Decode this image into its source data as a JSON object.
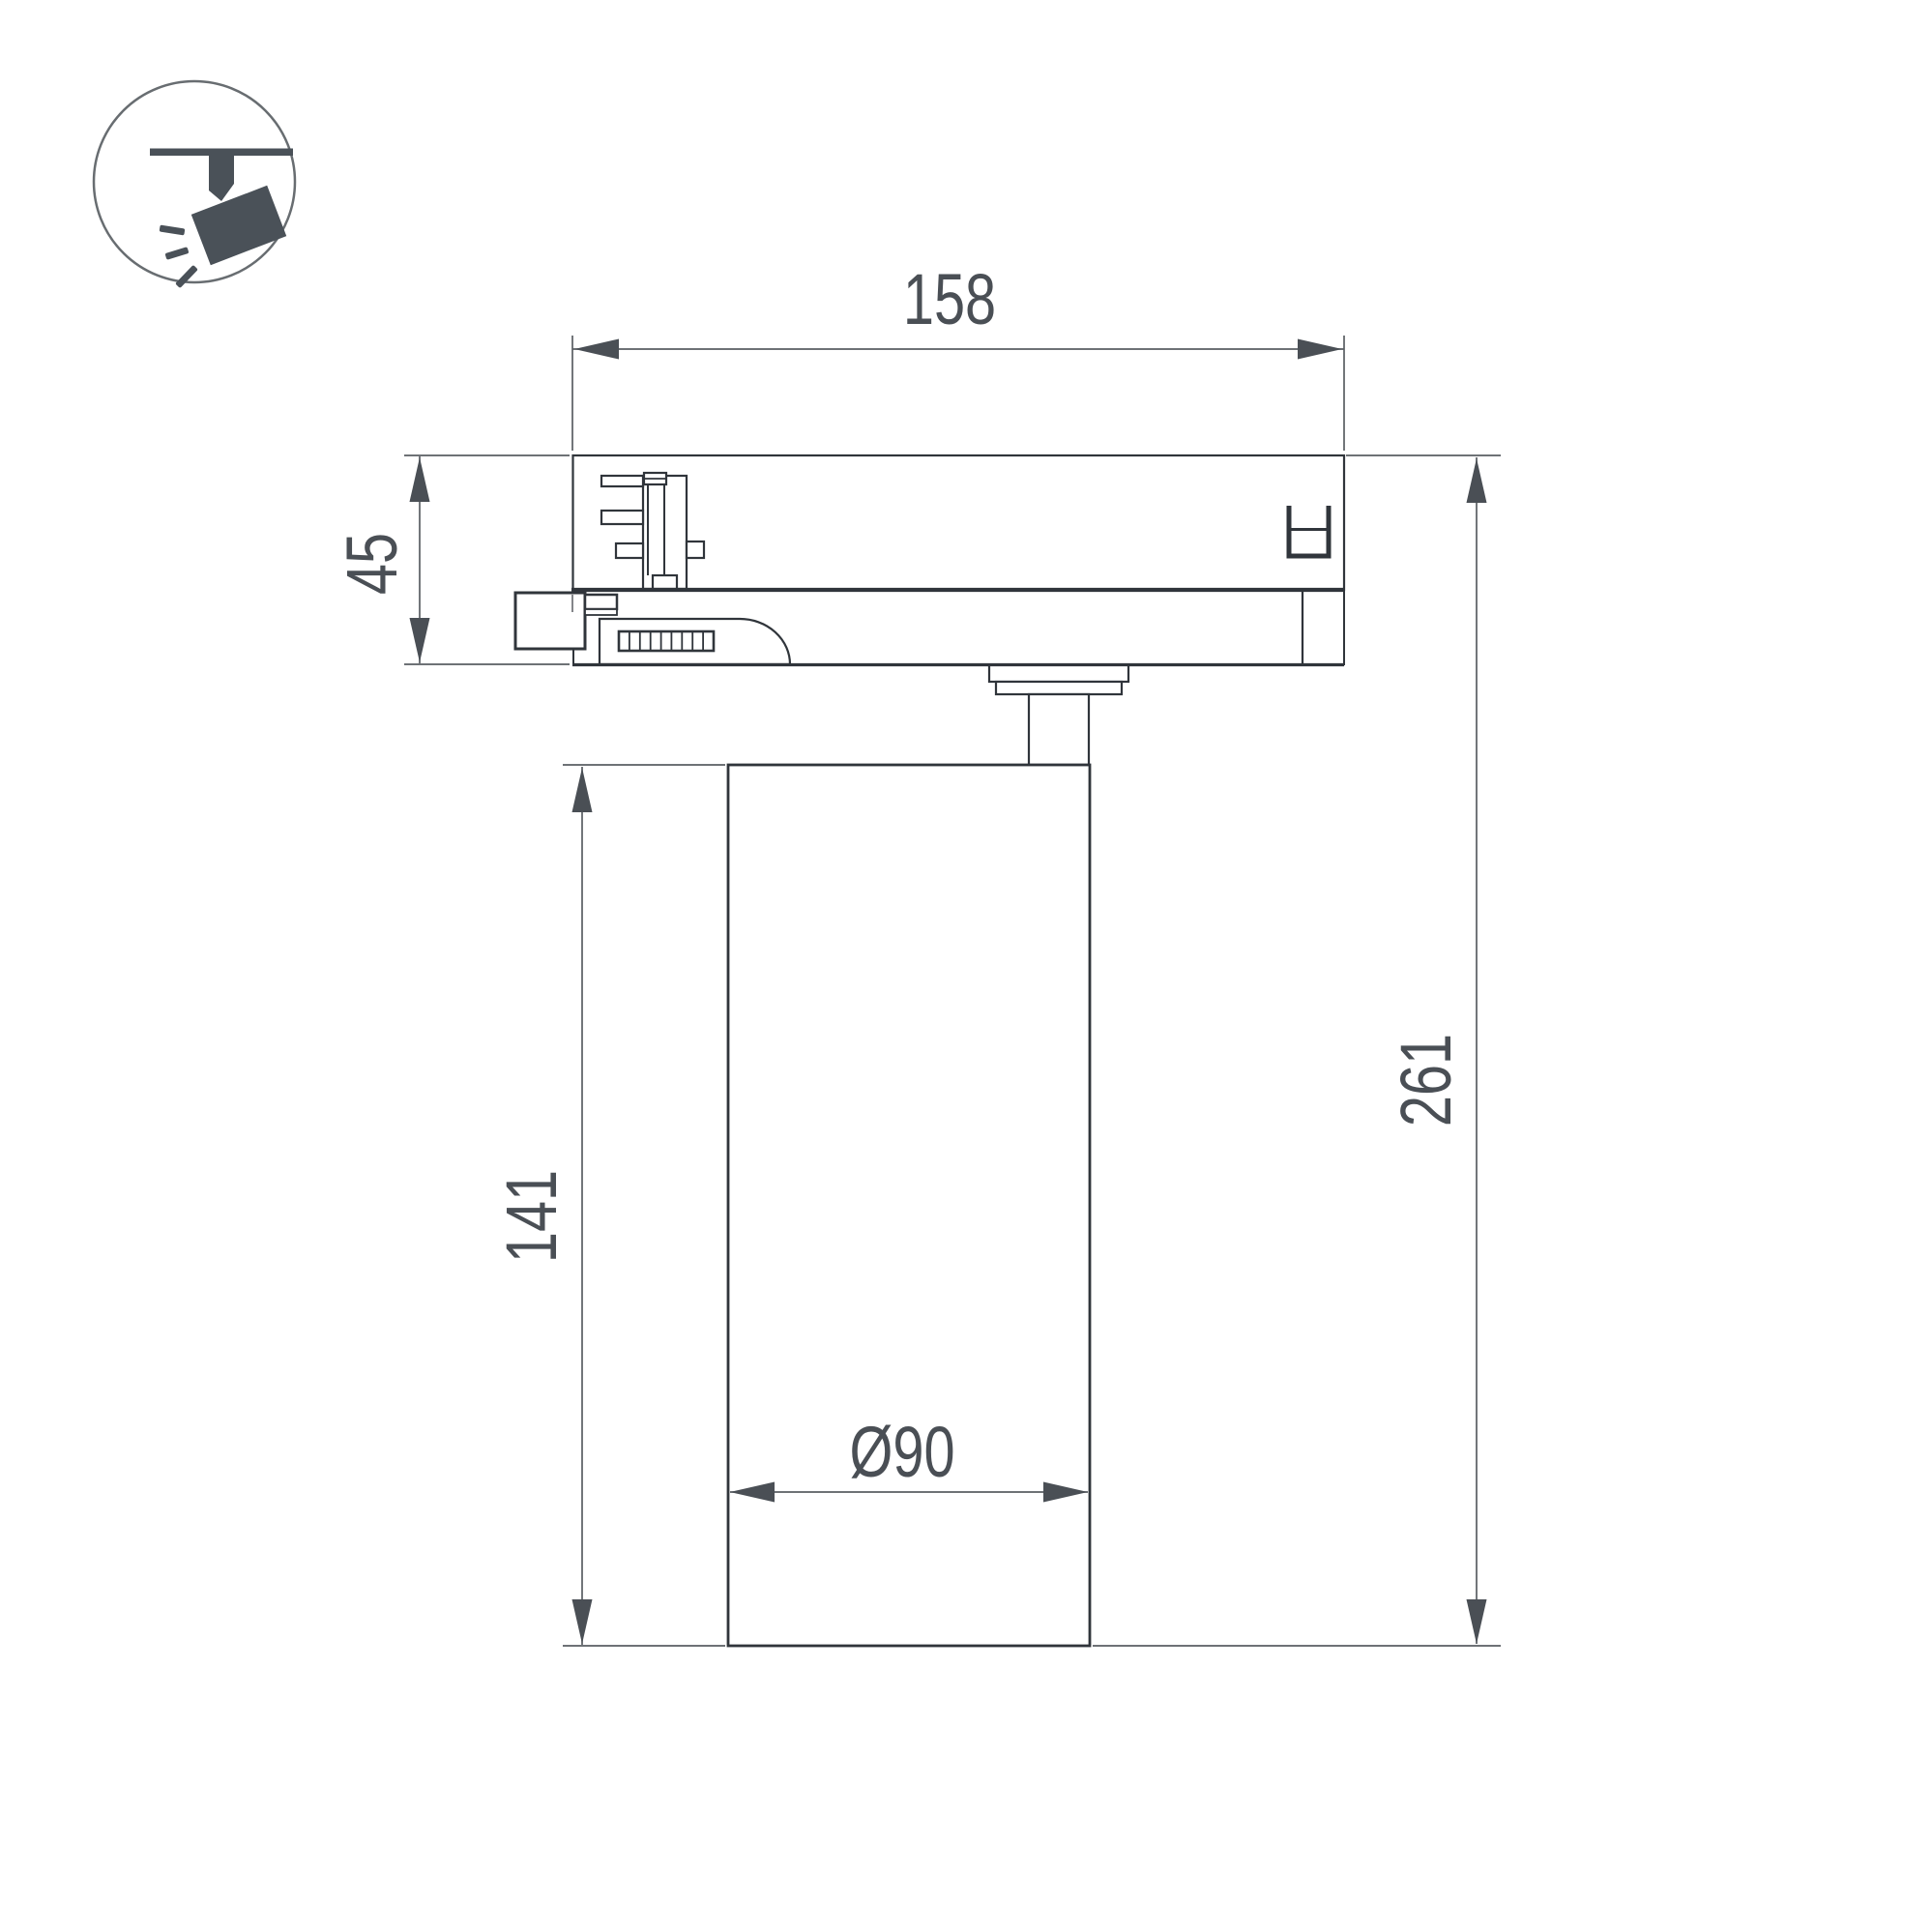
{
  "drawing": {
    "title": "track-spotlight-dimensional-drawing",
    "dimensions": {
      "track_adapter_length": "158",
      "track_adapter_height": "45",
      "body_height": "141",
      "total_height": "261",
      "body_diameter": "Ø90"
    }
  },
  "icon": {
    "name": "track-spotlight-icon"
  },
  "colors": {
    "background": "#ffffff",
    "outline": "#30353b",
    "dimension_line": "#5a5e63",
    "dimension_text": "#4a4f55",
    "icon_fill": "#4a5158",
    "icon_circle_stroke": "#686d71"
  }
}
